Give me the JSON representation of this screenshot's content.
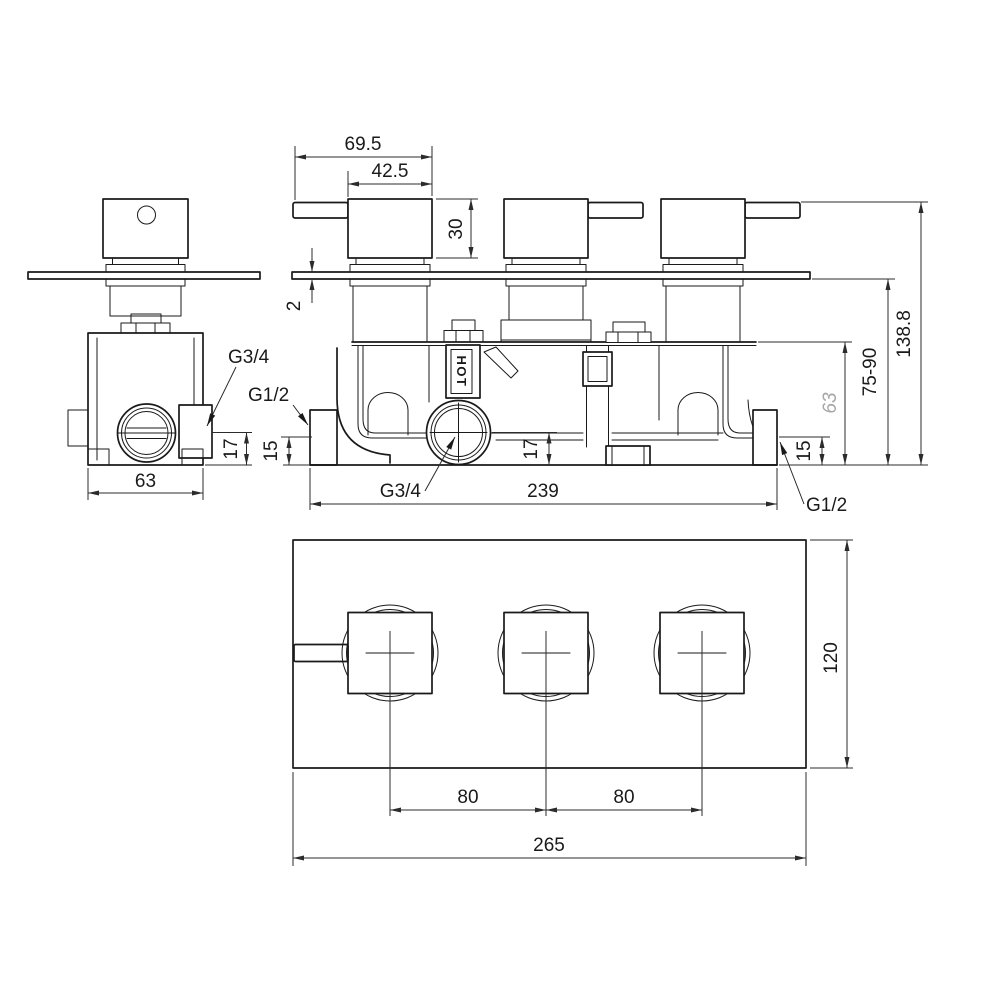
{
  "drawing": {
    "type": "technical-dimension-drawing",
    "subject": "triple-concealed-thermostatic-shower-valve",
    "colors": {
      "background": "#ffffff",
      "line": "#1a1a1a",
      "dimension": "#2b2b2b",
      "reference_dim": "#a6a6a6"
    },
    "side_view": {
      "dims": {
        "body_width": "63",
        "port_offset": "17"
      },
      "labels": {
        "outlet_port": "G3/4"
      }
    },
    "front_view": {
      "dims": {
        "handle_total_depth": "69.5",
        "handle_body_depth": "42.5",
        "handle_height": "30",
        "plate_thickness": "2",
        "total_height": "138.8",
        "install_depth_range": "75-90",
        "body_height_ref": "63",
        "inlet_offset_left": "15",
        "inlet_offset_right": "15",
        "outlet_offset": "17",
        "body_width": "239"
      },
      "labels": {
        "inlet_left": "G1/2",
        "inlet_right": "G1/2",
        "outlet_bottom": "G3/4",
        "hot_marking": "HOT"
      }
    },
    "plate_view": {
      "dims": {
        "handle_spacing_left": "80",
        "handle_spacing_right": "80",
        "plate_width": "265",
        "plate_height": "120"
      }
    }
  }
}
